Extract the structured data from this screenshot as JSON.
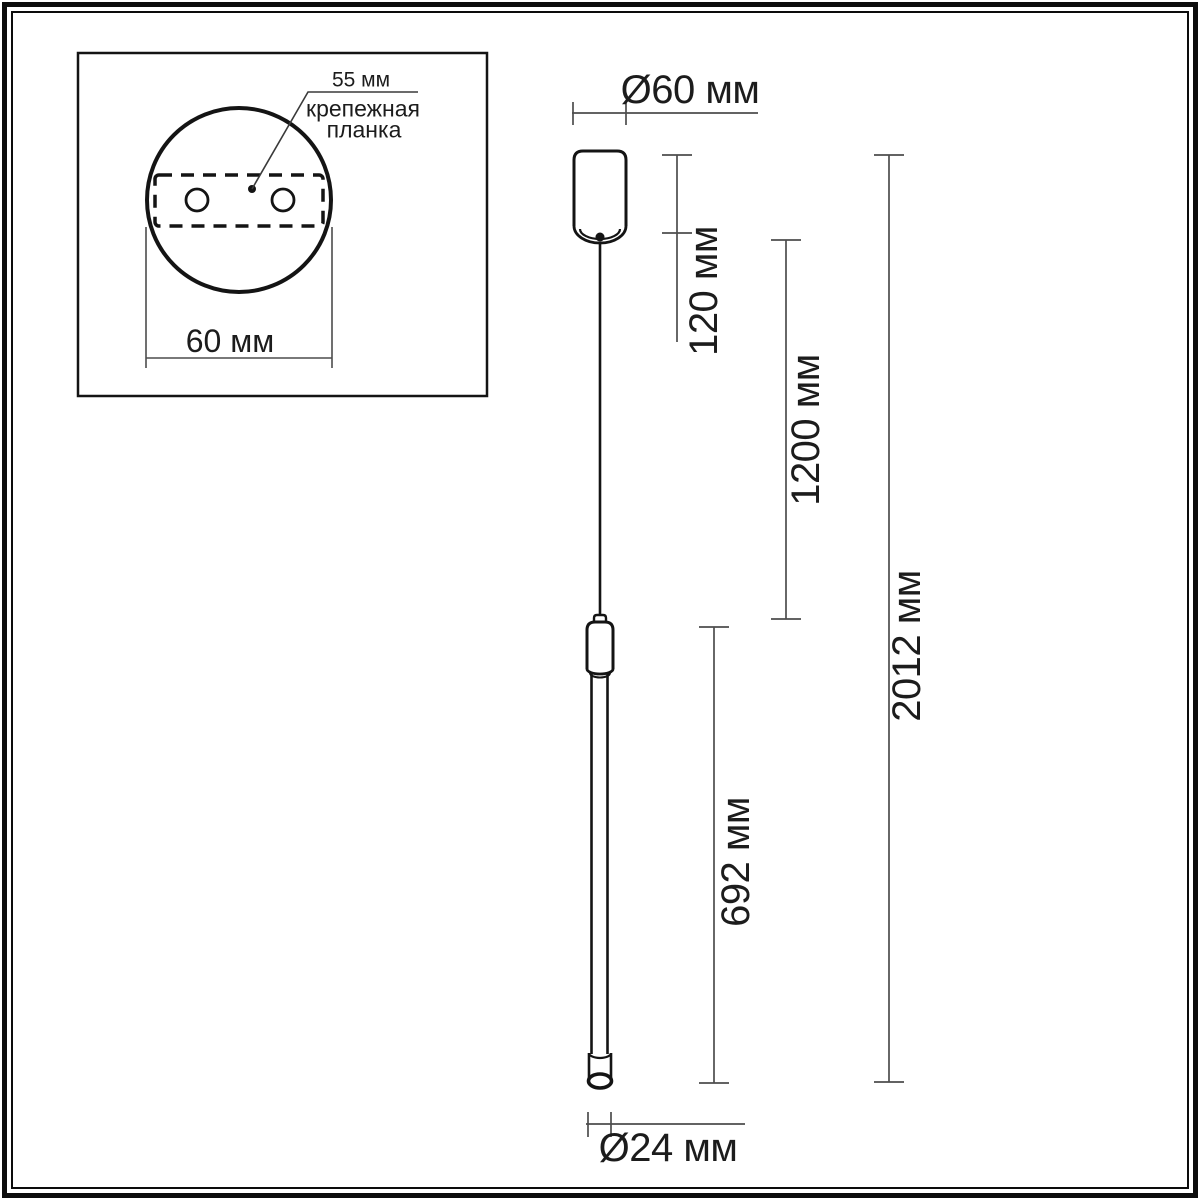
{
  "inset": {
    "spacing_label": "55 мм",
    "plate_label_line1": "крепежная",
    "plate_label_line2": "планка",
    "width_label": "60 мм"
  },
  "dimensions": {
    "canopy_diameter_label": "Ø60 мм",
    "canopy_height_label": "120 мм",
    "cable_length_label": "1200 мм",
    "overall_length_label": "2012 мм",
    "tube_length_label": "692 мм",
    "tube_diameter_label": "Ø24 мм"
  },
  "colors": {
    "background": "#ffffff",
    "outline": "#141414",
    "dimension_line": "#4d4d4d",
    "text": "#1c1c1c"
  }
}
